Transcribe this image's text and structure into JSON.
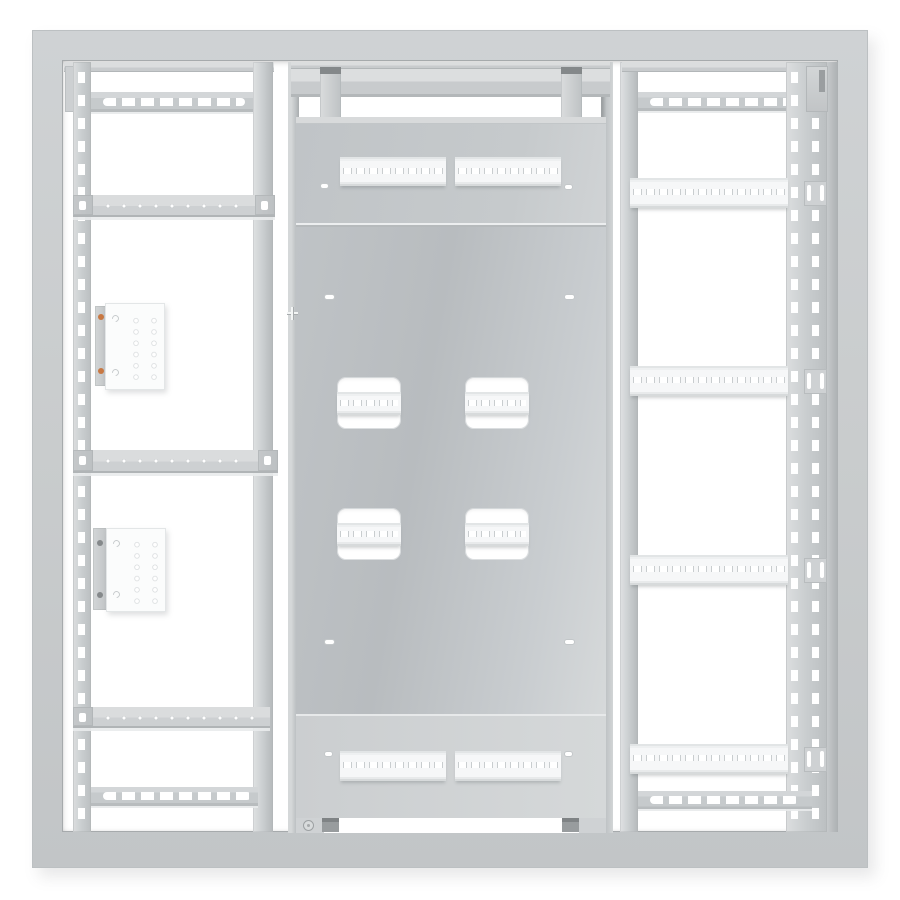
{
  "scene": {
    "object": "wall-mount electrical enclosure interior mounting frame, front view render",
    "background": "#ffffff",
    "visible_text": ""
  },
  "colors": {
    "frame": "#c9cccd",
    "frame_edge": "#a6aaac",
    "member": "#ccd0d2",
    "plate_dark": "#b8bcbf",
    "plate_light": "#d6d9da",
    "rail_white": "#f6f7f8",
    "hole_outline": "#c9cdcf",
    "module_white": "#fbfcfc",
    "accent_orange": "#c87843",
    "notch_dark": "#85898b"
  },
  "components": {
    "left_bay": {
      "vertical_punched_rails": 1,
      "punched_cross_bars": 2,
      "hole_strips": 3,
      "terminal_modules": 2,
      "module_hole_grid": "2 x 6",
      "module_fastener_colors": [
        "orange",
        "dark-gray"
      ]
    },
    "center_bay": {
      "mounting_plate_sections": 3,
      "top_din_rails": 2,
      "bottom_din_rails": 2,
      "din_rail_cutouts": 4,
      "oval_knockouts": 8,
      "hanger_brackets": 2,
      "ground_stud": 1,
      "cable_notches": 2,
      "alignment_cross": 1
    },
    "right_bay": {
      "din_rails": 4,
      "rail_end_brackets": 4,
      "punched_cross_bars": 2,
      "vertical_punched_rails": 1
    }
  },
  "icons": {
    "ground_stud": "◎",
    "alignment_cross": "+"
  }
}
